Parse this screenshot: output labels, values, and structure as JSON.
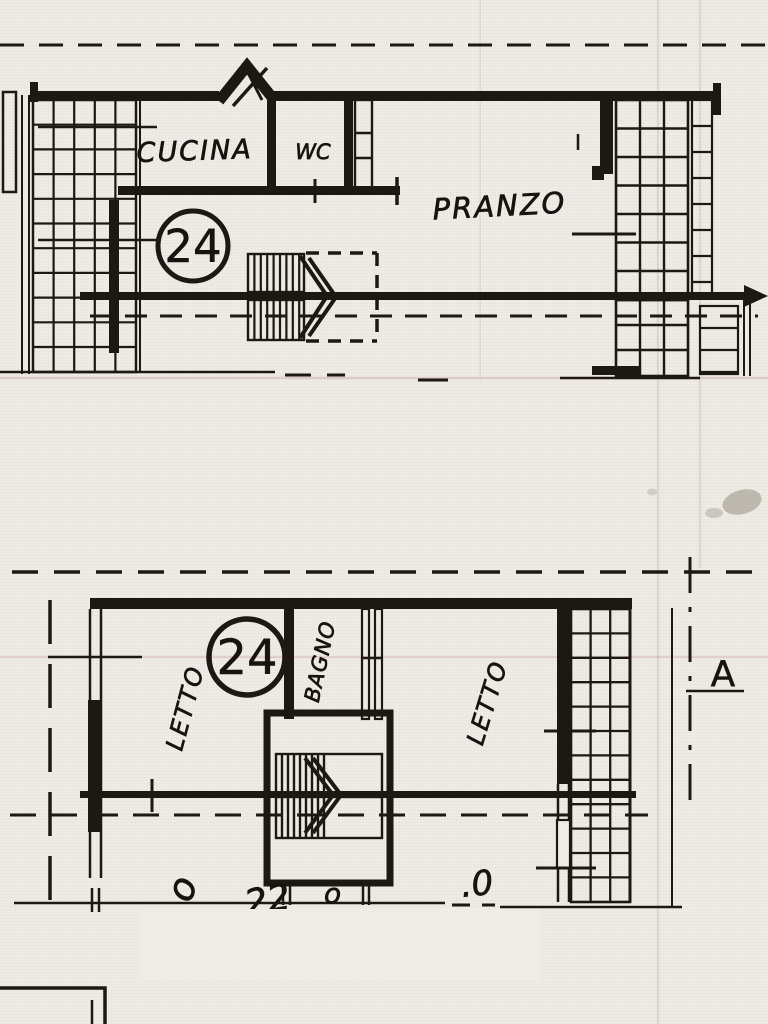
{
  "scan": {
    "ink_color": "#1c1814",
    "paper_color": "#efece7"
  },
  "upper_plan": {
    "unit_number": "24",
    "rooms": {
      "kitchen": "CUCINA",
      "wc": "WC",
      "dining": "PRANZO"
    }
  },
  "lower_plan": {
    "unit_number": "24",
    "rooms": {
      "bedroom_left": "LETTO",
      "bathroom": "BAGNO",
      "bedroom_right": "LETTO"
    },
    "section_marker": "A"
  },
  "cutoff_labels": {
    "g1": "o",
    "g2": "22",
    "g3": "o",
    "g4": ".0"
  }
}
